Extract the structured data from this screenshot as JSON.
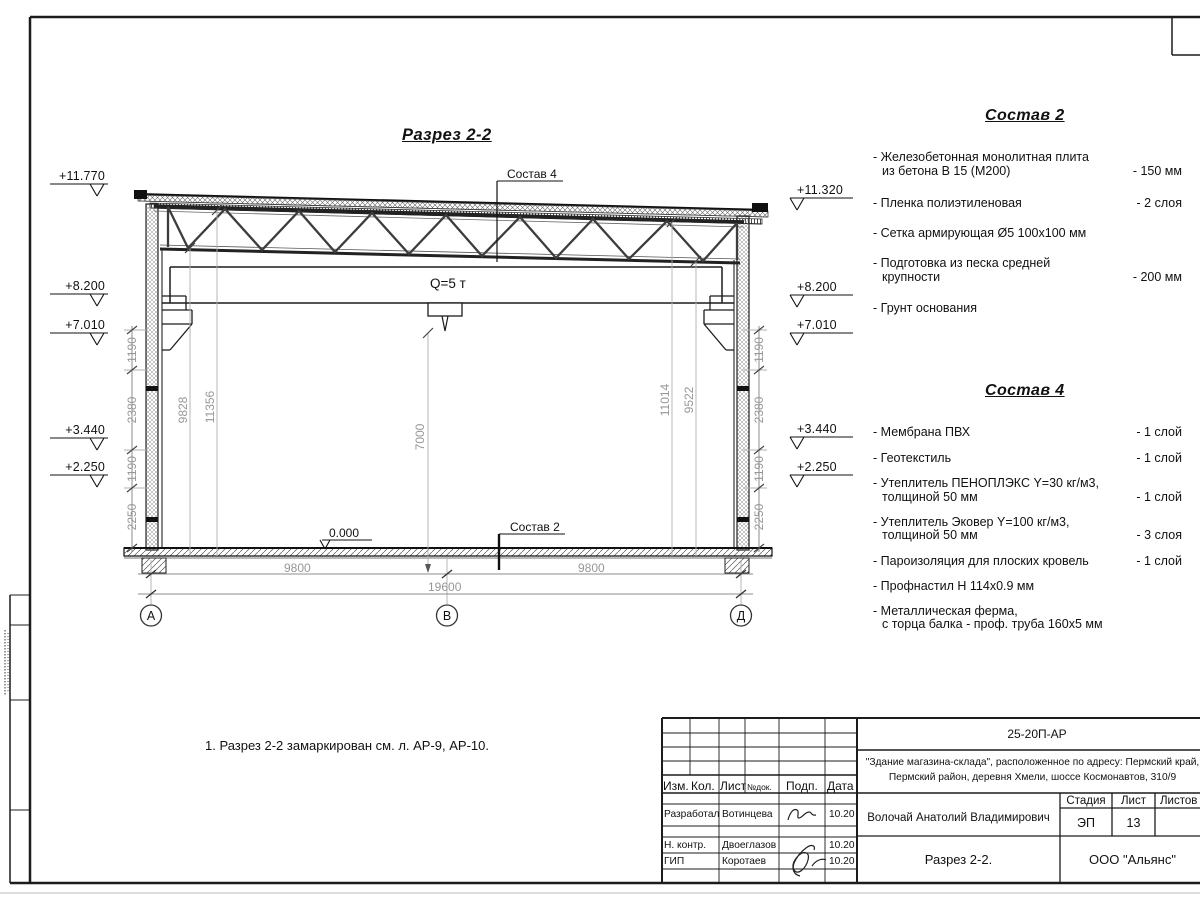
{
  "drawing": {
    "section_title": "Разрез 2-2",
    "note": "1. Разрез 2-2 замаркирован см. л. АР-9, АР-10.",
    "crane_capacity": "Q=5 т",
    "zero_level": "0.000",
    "callout_roof": "Состав 4",
    "callout_floor": "Состав 2",
    "axes": {
      "a": "А",
      "b": "В",
      "d": "Д"
    },
    "elevations_left": {
      "e1": "+11.770",
      "e2": "+8.200",
      "e3": "+7.010",
      "e4": "+3.440",
      "e5": "+2.250"
    },
    "elevations_right": {
      "e1": "+11.320",
      "e2": "+8.200",
      "e3": "+7.010",
      "e4": "+3.440",
      "e5": "+2.250"
    },
    "dims": {
      "left_chain": {
        "d1": "1190",
        "d2": "2380",
        "d3": "1190",
        "d4": "2250"
      },
      "right_chain": {
        "d1": "1190",
        "d2": "2380",
        "d3": "1190",
        "d4": "2250"
      },
      "interior": {
        "d1": "9828",
        "d2": "11356",
        "d3": "7000",
        "d4": "11014",
        "d5": "9522"
      },
      "bottom": {
        "left": "9800",
        "right": "9800",
        "total": "19600"
      }
    }
  },
  "sostav2": {
    "heading": "Состав 2",
    "items": [
      {
        "l1": "- Железобетонная  монолитная плита",
        "l2": "из бетона В 15 (М200)",
        "val": "- 150 мм"
      },
      {
        "l1": "- Пленка полиэтиленовая",
        "l2": "",
        "val": "-  2 слоя"
      },
      {
        "l1": "- Сетка армирующая Ø5 100х100 мм",
        "l2": "",
        "val": ""
      },
      {
        "l1": "- Подготовка из песка средней",
        "l2": "крупности",
        "val": "- 200 мм"
      },
      {
        "l1": "- Грунт основания",
        "l2": "",
        "val": ""
      }
    ]
  },
  "sostav4": {
    "heading": "Состав 4",
    "items": [
      {
        "l1": "- Мембрана ПВХ",
        "l2": "",
        "val": "- 1 слой"
      },
      {
        "l1": "- Геотекстиль",
        "l2": "",
        "val": "- 1 слой"
      },
      {
        "l1": "- Утеплитель ПЕНОПЛЭКС Y=30 кг/м3,",
        "l2": "толщиной 50 мм",
        "val": "- 1 слой"
      },
      {
        "l1": "- Утеплитель Эковер Y=100 кг/м3,",
        "l2": "толщиной 50 мм",
        "val": "- 3 слоя"
      },
      {
        "l1": "- Пароизоляция для плоских кровель",
        "l2": "",
        "val": "- 1 слой"
      },
      {
        "l1": "- Профнастил Н 114х0.9 мм",
        "l2": "",
        "val": ""
      },
      {
        "l1": "- Металлическая ферма,",
        "l2": "с торца балка - проф. труба 160х5 мм",
        "val": ""
      }
    ]
  },
  "titleblock": {
    "doc_number": "25-20П-АР",
    "project_line1": "\"Здание магазина-склада\", расположенное по адресу: Пермский край,",
    "project_line2": "Пермский район, деревня Хмели, шоссе Космонавтов, 310/9",
    "col_izm": "Изм.",
    "col_kol": "Кол.",
    "col_list": "Лист",
    "col_ndok": "№док.",
    "col_podp": "Подп.",
    "col_data": "Дата",
    "row1_role": "Разработал",
    "row1_name": "Вотинцева",
    "row1_date": "10.20",
    "row2_role": "Н. контр.",
    "row2_name": "Двоеглазов",
    "row2_date": "10.20",
    "row3_role": "ГИП",
    "row3_name": "Коротаев",
    "row3_date": "10.20",
    "approver": "Волочай Анатолий Владимирович",
    "stage_label": "Стадия",
    "sheet_label": "Лист",
    "sheets_label": "Листов",
    "stage_value": "ЭП",
    "sheet_value": "13",
    "drawing_name": "Разрез 2-2.",
    "company": "ООО \"Альянс\""
  }
}
